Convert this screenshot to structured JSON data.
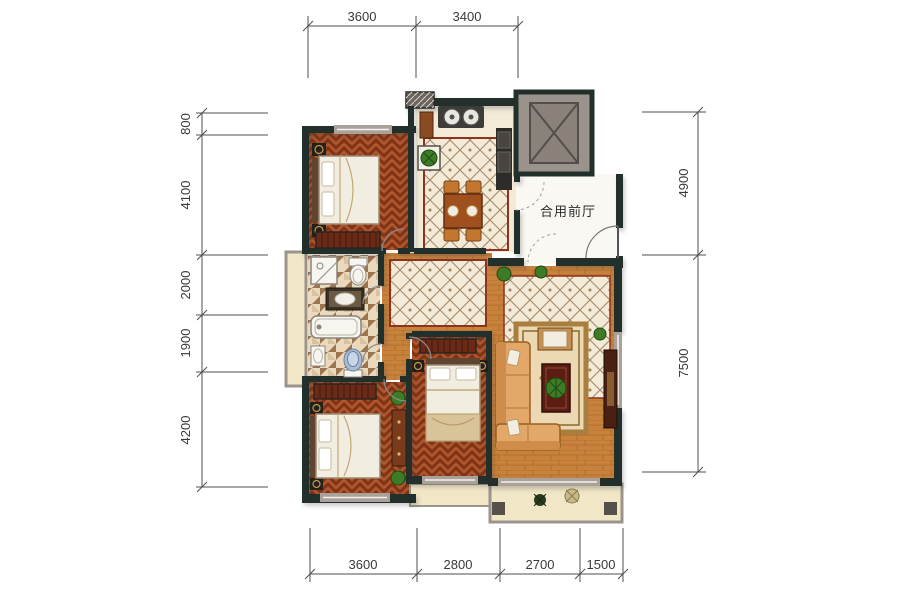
{
  "plan": {
    "hall_label": "合用前厅"
  },
  "dimensions": {
    "top": [
      "3600",
      "3400"
    ],
    "left": [
      "800",
      "4100",
      "2000",
      "1900",
      "4200"
    ],
    "right": [
      "4900",
      "7500"
    ],
    "bottom": [
      "3600",
      "2800",
      "2700",
      "1500"
    ]
  },
  "colors": {
    "wall": "#232f2b",
    "window-frame": "#a9a19a",
    "wood-dark": "#a34a24",
    "wood-chevron": "#7c3315",
    "wood-mid": "#b86236",
    "wood-light": "#c8823c",
    "tile-cream": "#f3ead7",
    "tile-line": "#a58a67",
    "tile-border": "#8e3320",
    "bath-light": "#ead9bd",
    "bath-dark": "#9b7450",
    "balcony-floor": "#f1e7c6",
    "hall-floor": "#faf8f3",
    "elevator": "#9a938b",
    "sofa": "#e3a869",
    "rug": "#ecd9b4",
    "rug-border": "#a87f3f",
    "bed-white": "#f2ede1",
    "plant": "#3e7b26",
    "dim-line": "#4f4f4f",
    "dim-text": "#3a3a3a"
  }
}
